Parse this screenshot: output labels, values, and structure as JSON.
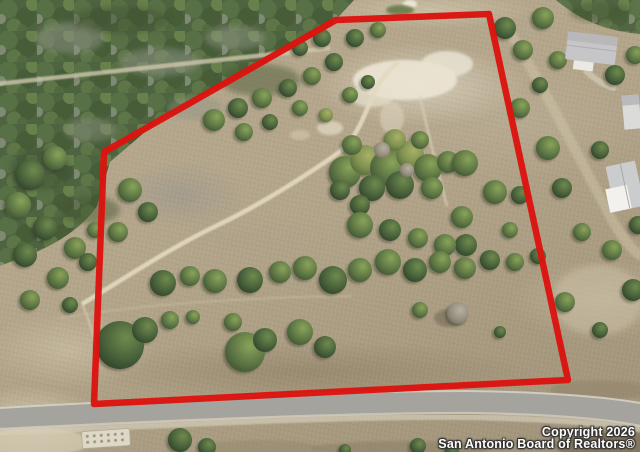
{
  "image": {
    "type": "aerial-property-photo",
    "description": "Drone aerial photo of a roughly five-sided vacant land parcel outlined in red, with scattered oak and juniper trees, a light dirt trail winding through the lot, a white caliche clearing, dense woodland to the upper left, neighboring houses on the right, and a paved road running along the bottom edge."
  },
  "boundary": {
    "color": "#dc1410",
    "stroke_width": 6.5,
    "points": "336,20 489,14 568,380 94,404 104,152"
  },
  "watermark": {
    "line1": "Copyright 2026",
    "line2": "San Antonio Board of Realtors®",
    "color": "#ffffff"
  },
  "scene": {
    "features": [
      "dense-woodland-top-left",
      "dirt-trail",
      "caliche-clearing",
      "tree-belt",
      "paved-road-bottom",
      "houses-right",
      "concrete-pad-bottom-left"
    ]
  }
}
